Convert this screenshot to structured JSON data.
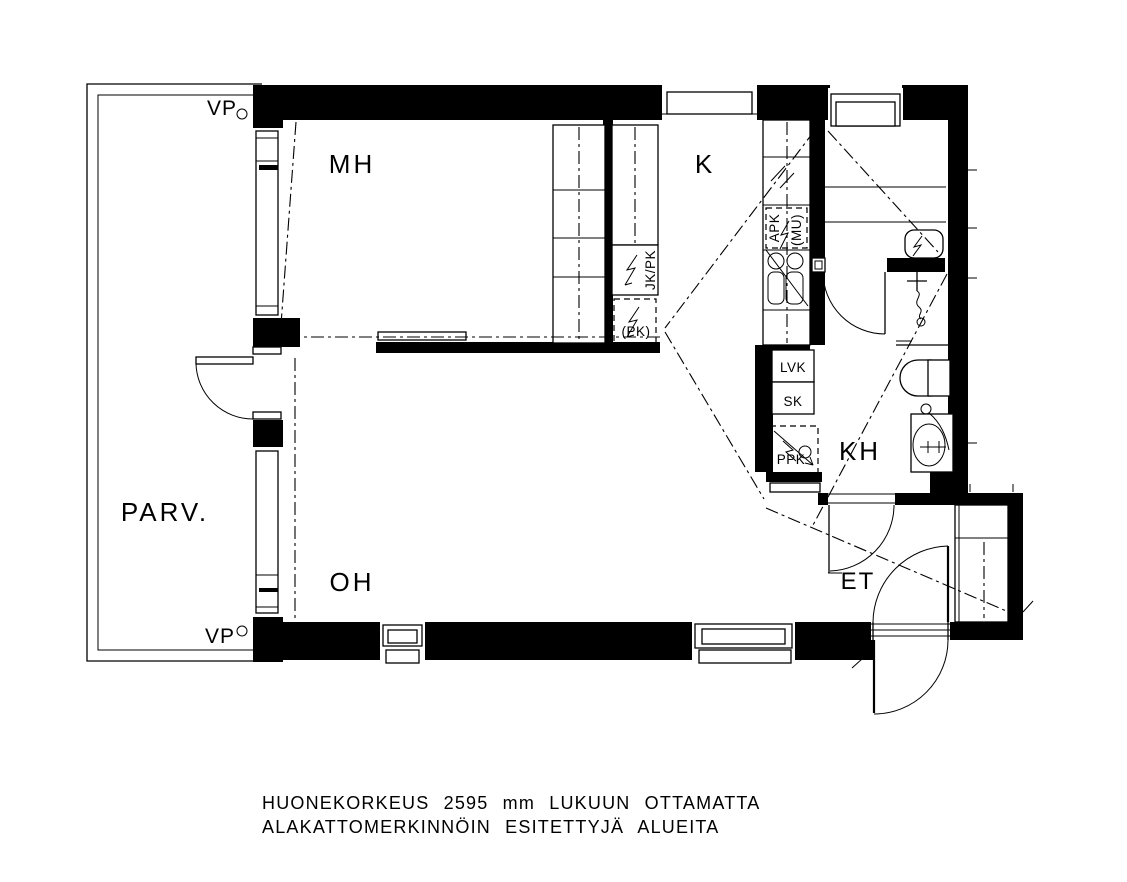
{
  "floor_plan": {
    "room_labels": {
      "bedroom": "MH",
      "kitchen": "K",
      "living_room": "OH",
      "bathroom": "KH",
      "entry_hall": "ET",
      "balcony": "PARV."
    },
    "fixture_labels": {
      "vp_marker_top": "VP",
      "vp_marker_bottom": "VP",
      "fridge_freezer": "JK/PK",
      "freezer_reservation": "(PK)",
      "dishwasher": "APK",
      "microwave_reservation": "(MU)",
      "heater_cabinet": "LVK",
      "cleaning_cabinet": "SK",
      "washing_machine_reservation": "PPK"
    },
    "notes": {
      "line1": "HUONEKORKEUS 2595 mm LUKUUN OTTAMATTA",
      "line2": "ALAKATTOMERKINNÖIN ESITETTYJÄ ALUEITA"
    },
    "colors": {
      "line": "#000000",
      "background": "#ffffff"
    }
  }
}
